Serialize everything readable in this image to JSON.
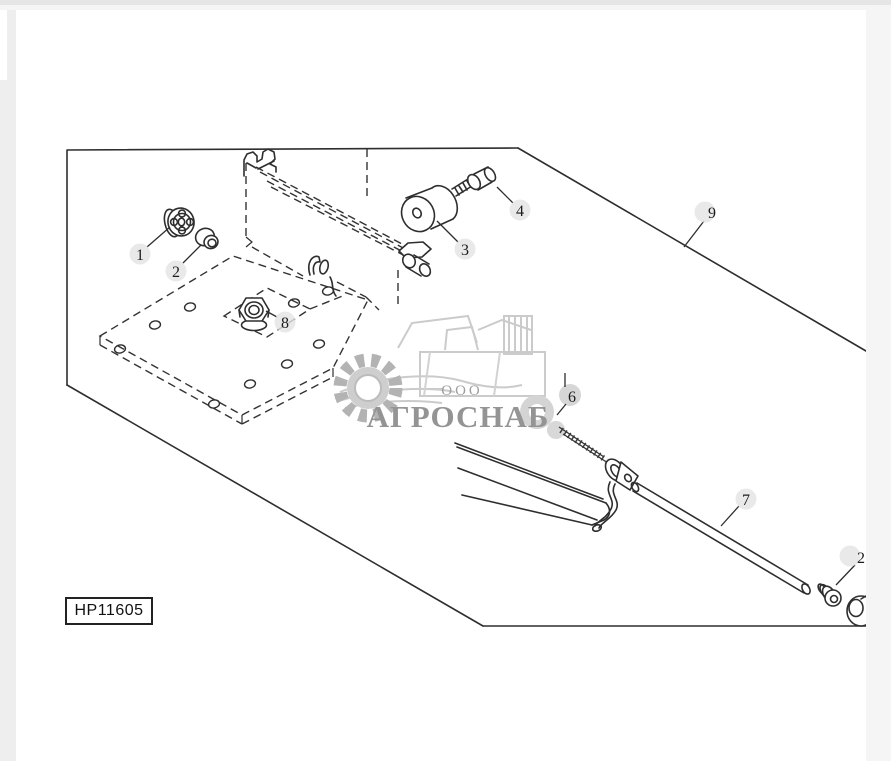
{
  "page": {
    "background": "#ffffff",
    "chrome": {
      "top_strip": "#e6e6e6",
      "left_strip": "#eeeeee",
      "right_strip": "#f5f5f5"
    }
  },
  "diagram": {
    "drawing_number": "HP11605",
    "type": "exploded-parts-diagram",
    "line_color": "#2e2e2e",
    "callout_circle_color": "#e3e3e3",
    "callouts": [
      {
        "label": "1"
      },
      {
        "label": "2"
      },
      {
        "label": "3"
      },
      {
        "label": "4"
      },
      {
        "label": "6"
      },
      {
        "label": "7"
      },
      {
        "label": "8"
      },
      {
        "label": "9"
      },
      {
        "label": "2"
      }
    ],
    "icons": [
      "knob-part",
      "bushing-part",
      "isolator-cylinder-part",
      "bolt-part",
      "nut-part",
      "threaded-shaft-part",
      "rod-part",
      "clamp-part",
      "grommet-part",
      "frame-outline",
      "mounting-plate-dashed"
    ]
  },
  "watermark": {
    "org_type": "ООО",
    "name": "АГРОСНАБ",
    "text_color": "#949494",
    "art_color": "#c8c8c8",
    "icons": [
      "gear-icon",
      "combine-harvester-icon",
      "wheat-swoosh-icon"
    ]
  }
}
